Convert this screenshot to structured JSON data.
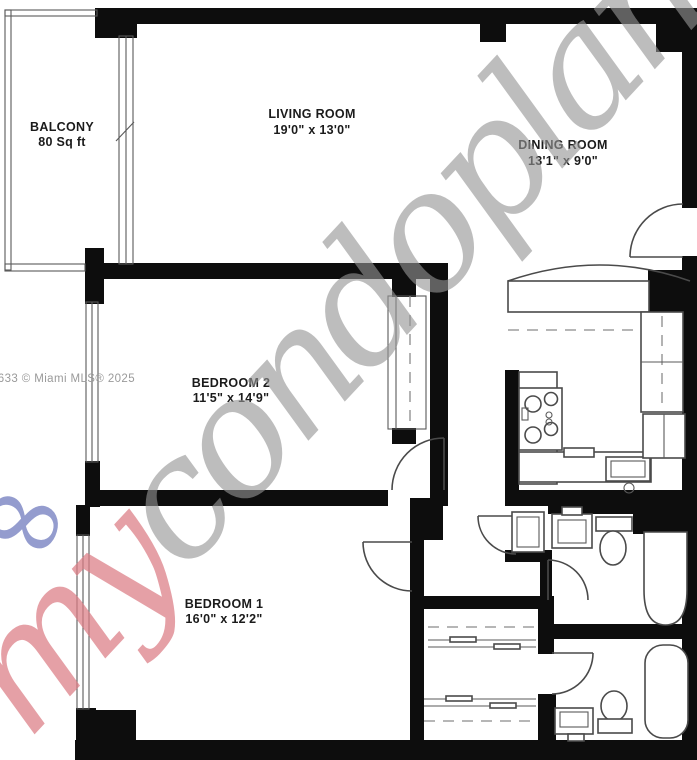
{
  "rooms": {
    "balcony": {
      "name": "BALCONY",
      "dims": "80 Sq ft"
    },
    "living": {
      "name": "LIVING ROOM",
      "dims": "19'0\" x 13'0\""
    },
    "dining": {
      "name": "DINING ROOM",
      "dims": "13'1\" x 9'0\""
    },
    "bedroom2": {
      "name": "BEDROOM 2",
      "dims": "11'5\" x 14'9\""
    },
    "bedroom1": {
      "name": "BEDROOM 1",
      "dims": "16'0\" x 12'2\""
    }
  },
  "credit": "2633 © Miami MLS® 2025",
  "watermark": {
    "prefix": "my",
    "suffix": "condoplans",
    "glyph": "∞"
  },
  "colors": {
    "wall": "#0d0d0d",
    "line": "#4a4a4a",
    "label": "#1b1b1b",
    "credit_gray": "#9a9a9a",
    "watermark_gray": "#949494",
    "watermark_pink": "#db7b83",
    "watermark_blue": "#7680c0"
  }
}
